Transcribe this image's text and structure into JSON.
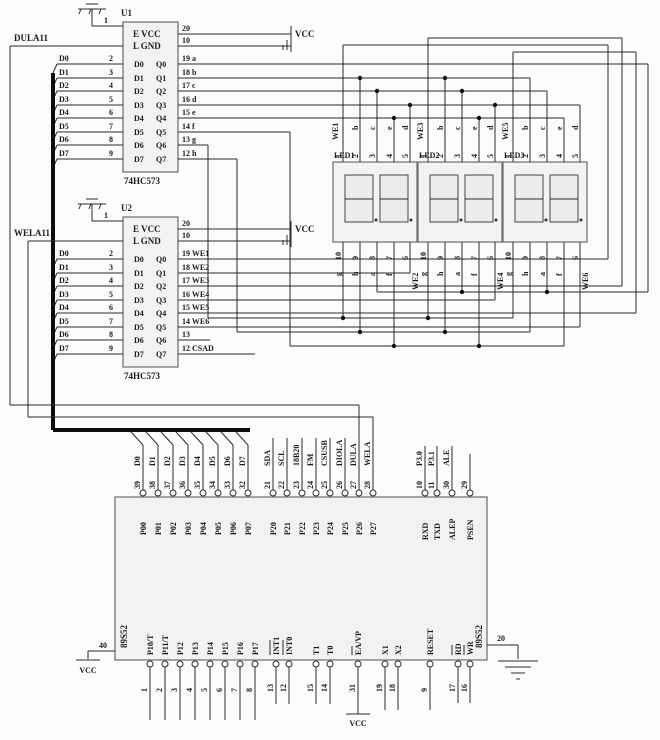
{
  "u1": {
    "ref": "U1",
    "part": "74HC573",
    "pin1": "1",
    "enable_net": "DULA11",
    "row_e": "E VCC",
    "row_l": "L GND",
    "vcc_pin": "20",
    "gnd_pin": "10",
    "inputs": [
      "D0",
      "D1",
      "D2",
      "D3",
      "D4",
      "D5",
      "D6",
      "D7"
    ],
    "input_pins": [
      "2",
      "3",
      "4",
      "5",
      "6",
      "7",
      "8",
      "9"
    ],
    "cols_d": [
      "D0",
      "D1",
      "D2",
      "D3",
      "D4",
      "D5",
      "D6",
      "D7"
    ],
    "cols_q": [
      "Q0",
      "Q1",
      "Q2",
      "Q3",
      "Q4",
      "Q5",
      "Q6",
      "Q7"
    ],
    "outputs": [
      "19 a",
      "18 b",
      "17 c",
      "16 d",
      "15 e",
      "14 f",
      "13 g",
      "12 h"
    ]
  },
  "u2": {
    "ref": "U2",
    "part": "74HC573",
    "pin1": "1",
    "enable_net": "WELA11",
    "row_e": "E VCC",
    "row_l": "L GND",
    "vcc_pin": "20",
    "gnd_pin": "10",
    "inputs": [
      "D0",
      "D1",
      "D2",
      "D3",
      "D4",
      "D5",
      "D6",
      "D7"
    ],
    "input_pins": [
      "2",
      "3",
      "4",
      "5",
      "6",
      "7",
      "8",
      "9"
    ],
    "cols_d": [
      "D0",
      "D1",
      "D2",
      "D3",
      "D4",
      "D5",
      "D6",
      "D7"
    ],
    "cols_q": [
      "Q0",
      "Q1",
      "Q2",
      "Q3",
      "Q4",
      "Q5",
      "Q6",
      "Q7"
    ],
    "outputs": [
      "19 WE1",
      "18 WE2",
      "17 WE3",
      "16 WE4",
      "15 WE5",
      "14 WE6",
      "13",
      "12 CSAD"
    ]
  },
  "displays": {
    "top_pins": [
      "1",
      "2",
      "3",
      "4",
      "5"
    ],
    "top_segs": [
      "b",
      "c",
      "e",
      "d"
    ],
    "bottom_pins": [
      "10",
      "9",
      "8",
      "7"
    ],
    "pin6": "6",
    "bottom_segs": [
      "g",
      "h",
      "a",
      "f"
    ],
    "items": [
      {
        "ref": "LED1",
        "we_top": "WE1",
        "we_bottom": "WE2"
      },
      {
        "ref": "LED2",
        "we_top": "WE3",
        "we_bottom": "WE4"
      },
      {
        "ref": "LED3",
        "we_top": "WE5",
        "we_bottom": "WE6"
      }
    ]
  },
  "mcu": {
    "ref": "89S52",
    "p0_ports": [
      "P00",
      "P01",
      "P02",
      "P03",
      "P04",
      "P05",
      "P06",
      "P07"
    ],
    "p0_pins": [
      "39",
      "38",
      "37",
      "36",
      "35",
      "34",
      "33",
      "32"
    ],
    "p0_signals": [
      "D0",
      "D1",
      "D2",
      "D3",
      "D4",
      "D5",
      "D6",
      "D7"
    ],
    "p2_ports": [
      "P20",
      "P21",
      "P22",
      "P23",
      "P24",
      "P25",
      "P26",
      "P27"
    ],
    "p2_pins": [
      "21",
      "22",
      "23",
      "24",
      "25",
      "26",
      "27",
      "28"
    ],
    "p2_signals": [
      "SDA",
      "SCL",
      "18B20",
      "FM",
      "CSUSB",
      "DIOLA",
      "DULA",
      "WELA"
    ],
    "p3_ports": [
      "RXD",
      "TXD",
      "ALEP",
      "PSEN"
    ],
    "p3_pins": [
      "10",
      "11",
      "30",
      "29"
    ],
    "p3_signals": [
      "P3.0",
      "P3.1",
      "ALE"
    ],
    "bottom_ports": [
      "P10/T",
      "P11/T",
      "P12",
      "P13",
      "P14",
      "P15",
      "P16",
      "P17",
      "INT1",
      "INT0",
      "T1",
      "T0",
      "EA/VP",
      "X1",
      "X2",
      "RESET",
      "RD",
      "WR"
    ],
    "bottom_pins": [
      "1",
      "2",
      "3",
      "4",
      "5",
      "6",
      "7",
      "8",
      "13",
      "12",
      "15",
      "14",
      "31",
      "19",
      "18",
      "9",
      "17",
      "16"
    ],
    "vcc_pin": "40",
    "gnd_pin": "20"
  },
  "power": {
    "vcc": "VCC"
  }
}
